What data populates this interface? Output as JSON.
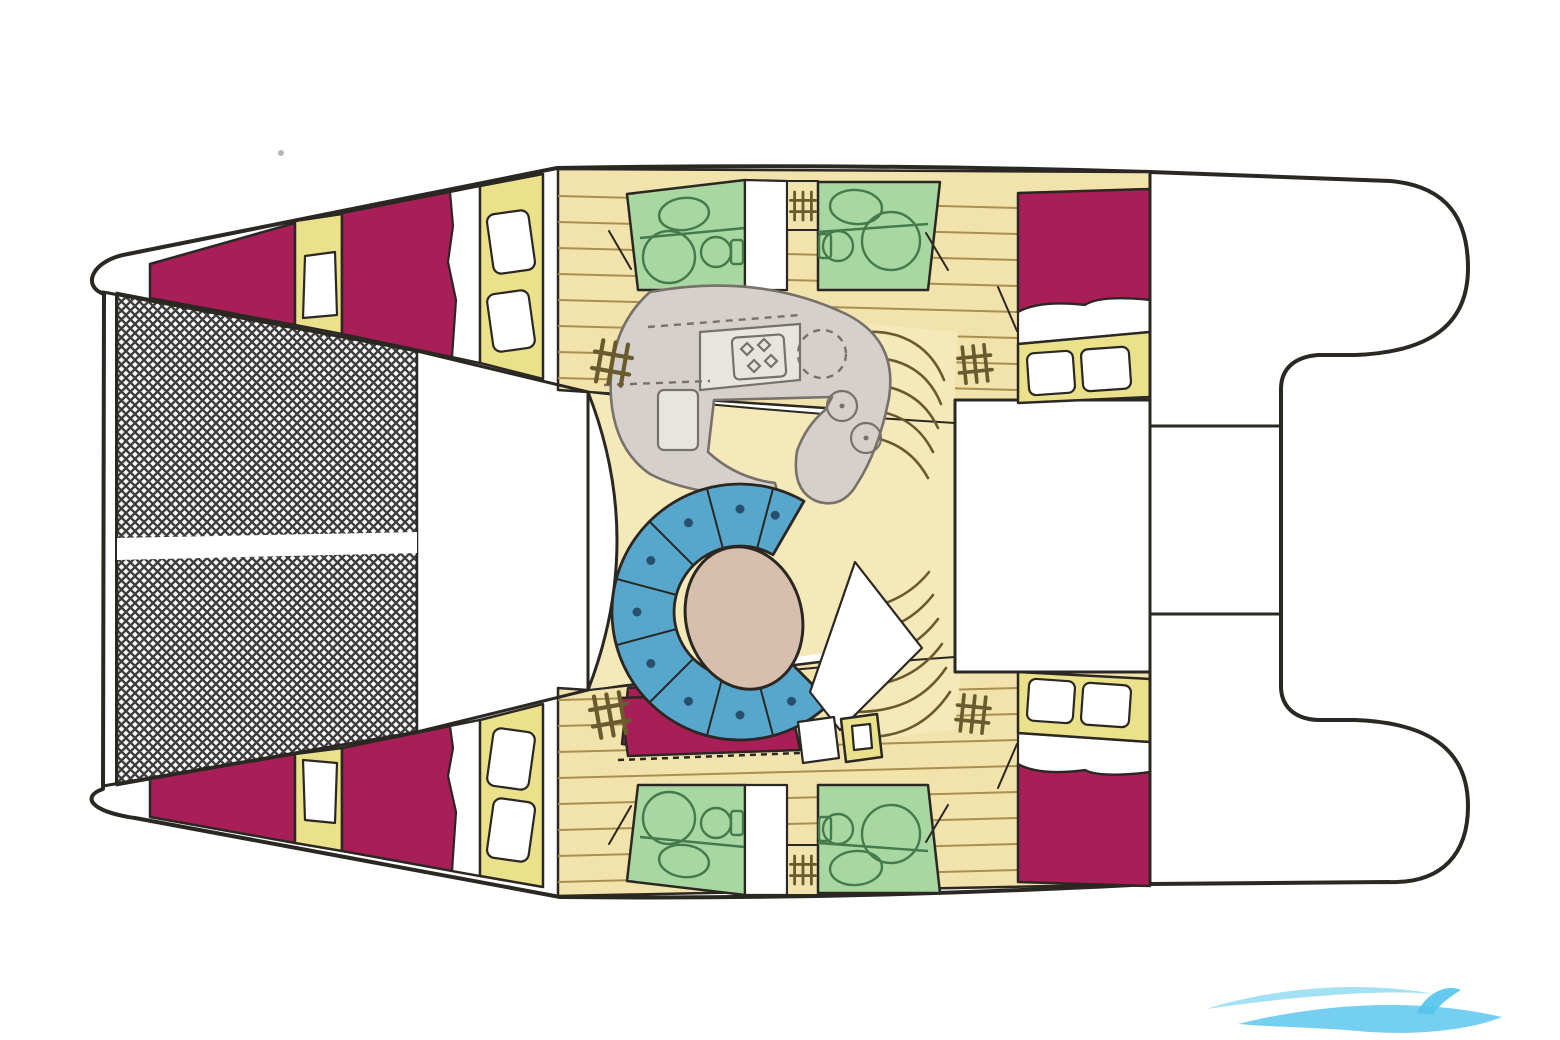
{
  "diagram": {
    "kind": "catamaran-interior-deck-plan",
    "orientation": "bow-left-stern-right",
    "features": [
      "trampoline-net",
      "bow-crossbeam",
      "port-hull",
      "starboard-hull",
      "port-forward-vberth",
      "port-forward-double-bed",
      "port-bathroom-forward",
      "port-bathroom-aft",
      "port-aft-double-bed",
      "starboard-forward-vberth",
      "starboard-forward-double-bed",
      "starboard-bathroom-forward",
      "starboard-bathroom-aft",
      "starboard-aft-double-bed",
      "saloon",
      "galley-counter",
      "galley-stove",
      "galley-sink",
      "galley-fridge",
      "dinette-sofa",
      "saloon-table",
      "companionway-stairs-port",
      "companionway-stairs-starboard",
      "aft-cockpit-deck",
      "stern-transom-steps",
      "watermark-swoosh"
    ],
    "counts": {
      "cabins": 4,
      "bathrooms": 4,
      "companionway_step_icons": 6
    }
  },
  "colors": {
    "outline": "#2b2722",
    "hull_white": "#ffffff",
    "bed": "#a81f58",
    "cabinet_yellow": "#ece18b",
    "floor_wood": "#f2e2ac",
    "plank_line": "#a98f4f",
    "floor_saloon": "#f6e9b9",
    "bathroom_green": "#a9d7a2",
    "bathroom_line": "#447a4c",
    "sofa_blue": "#57a7cd",
    "sofa_dot": "#27506b",
    "table_beige": "#d8beac",
    "galley_gray": "#d5d0cb",
    "galley_line": "#76716b",
    "counter_light": "#e8e4df",
    "net_line": "#3f3f3f",
    "stair_line": "#6b5a2e",
    "watermark_light": "#8fd9f2",
    "watermark_blue": "#53c3ec"
  }
}
